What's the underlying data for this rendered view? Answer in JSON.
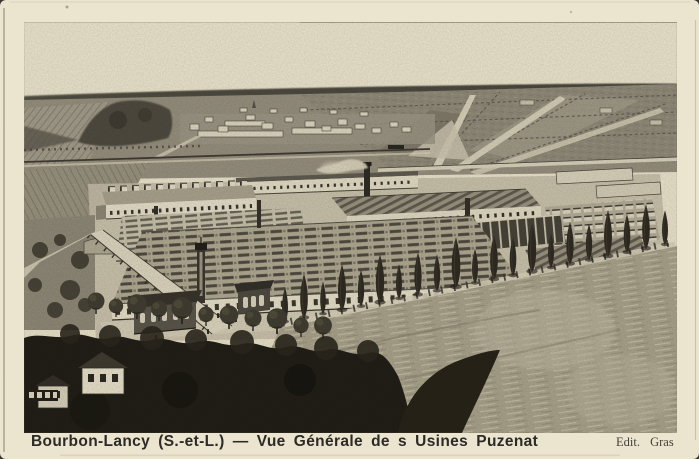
{
  "postcard": {
    "caption": "Bourbon-Lancy (S.-et-L.) — Vue Générale de s Usines Puzenat",
    "publisher": "Edit. Gras",
    "image_alt": "Aerial engraved view of the Puzenat factory works at Bourbon-Lancy: long workshops with sawtooth and monitor roofs, smoking chimney, storage yards, distant village and hedged fields, a row of poplars and dark trees with cottages in the foreground"
  },
  "colors": {
    "card_cream": "#ebe4ce",
    "ink": "#2b2a26",
    "horizon_gray": "#55524a",
    "foreground_dark": "#211e17"
  }
}
